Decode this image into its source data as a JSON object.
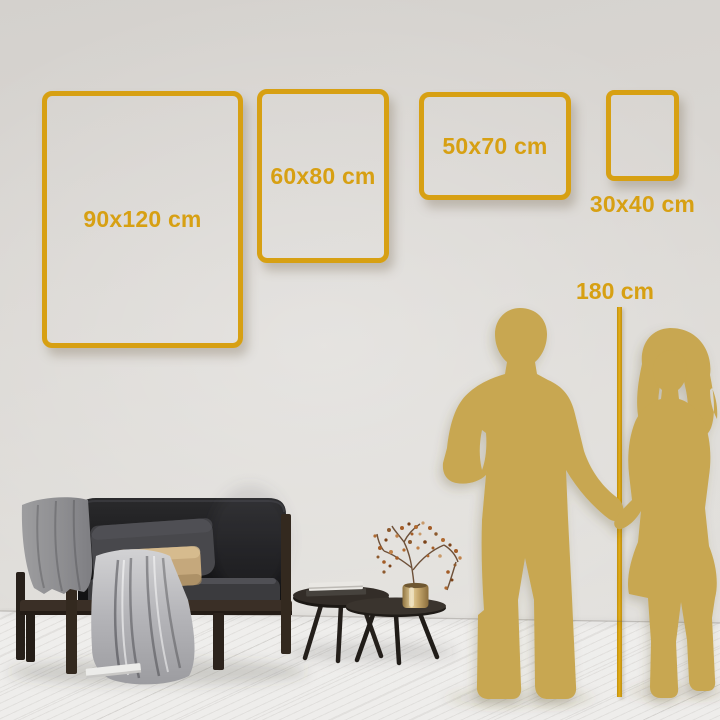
{
  "size_guide": {
    "frames": [
      {
        "id": "90x120",
        "label": "90x120 cm",
        "orientation": "portrait"
      },
      {
        "id": "60x80",
        "label": "60x80 cm",
        "orientation": "portrait"
      },
      {
        "id": "50x70",
        "label": "50x70 cm",
        "orientation": "landscape"
      },
      {
        "id": "30x40",
        "label": "30x40 cm",
        "orientation": "portrait"
      }
    ],
    "height_reference": {
      "label": "180 cm"
    }
  },
  "palette": {
    "accent_gold": "#d7a013",
    "silhouette_gold": "#c8a751",
    "wall": "#dad7d3",
    "floor": "#f0efed"
  }
}
